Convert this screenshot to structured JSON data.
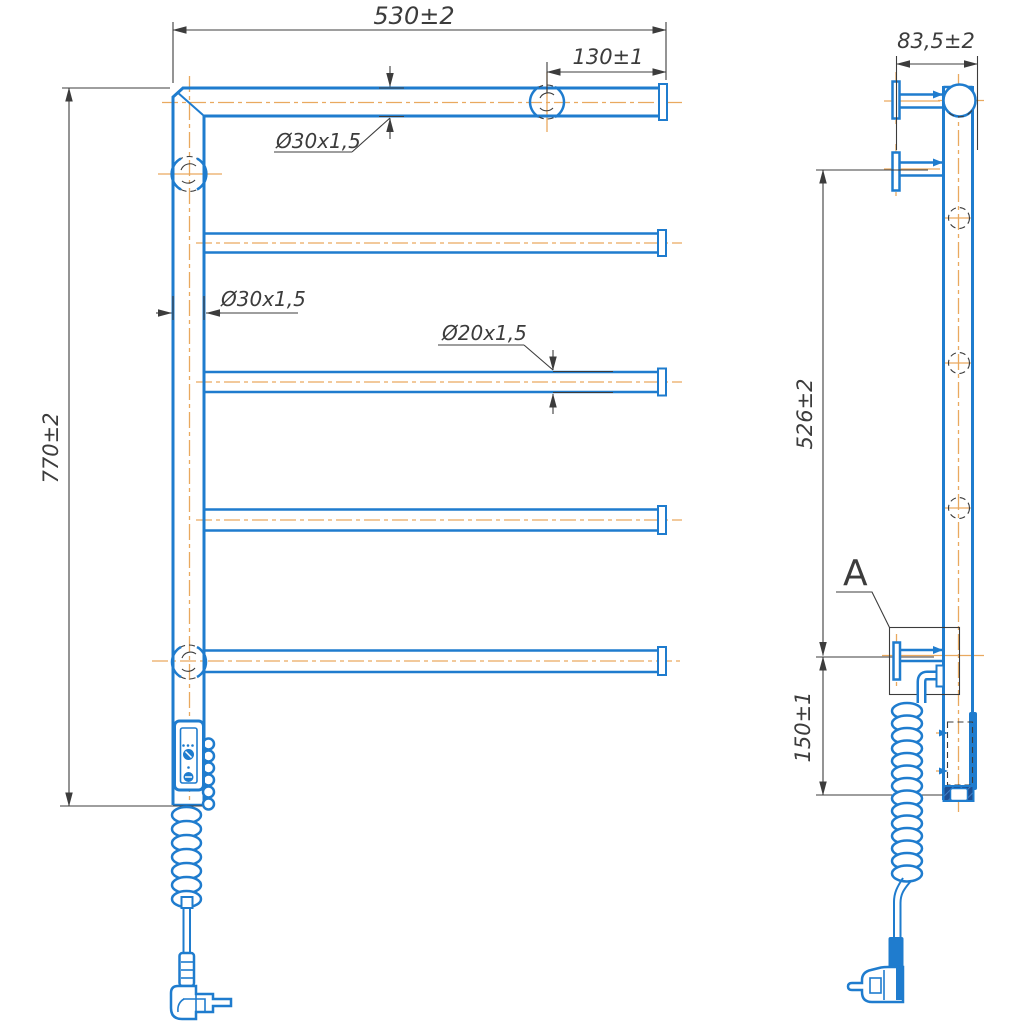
{
  "drawing": {
    "type": "technical-drawing-towel-rail",
    "colors": {
      "line_blue": "#1f7cce",
      "hatch_navy": "#1d4f93",
      "centerline_orange": "#e9a95f",
      "dimension_dark": "#3c3c3c",
      "background": "#ffffff"
    },
    "front_view": {
      "dimensions": {
        "overall_width": "530±2",
        "bracket_offset": "130±1",
        "overall_height": "770±2",
        "frame_tube_top": "Ø30x1,5",
        "frame_tube_side": "Ø30x1,5",
        "rung_tube": "Ø20x1,5"
      }
    },
    "side_view": {
      "dimensions": {
        "depth": "83,5±2",
        "bracket_span": "526±2",
        "heater_offset": "150±1"
      },
      "detail_label": "A"
    }
  }
}
